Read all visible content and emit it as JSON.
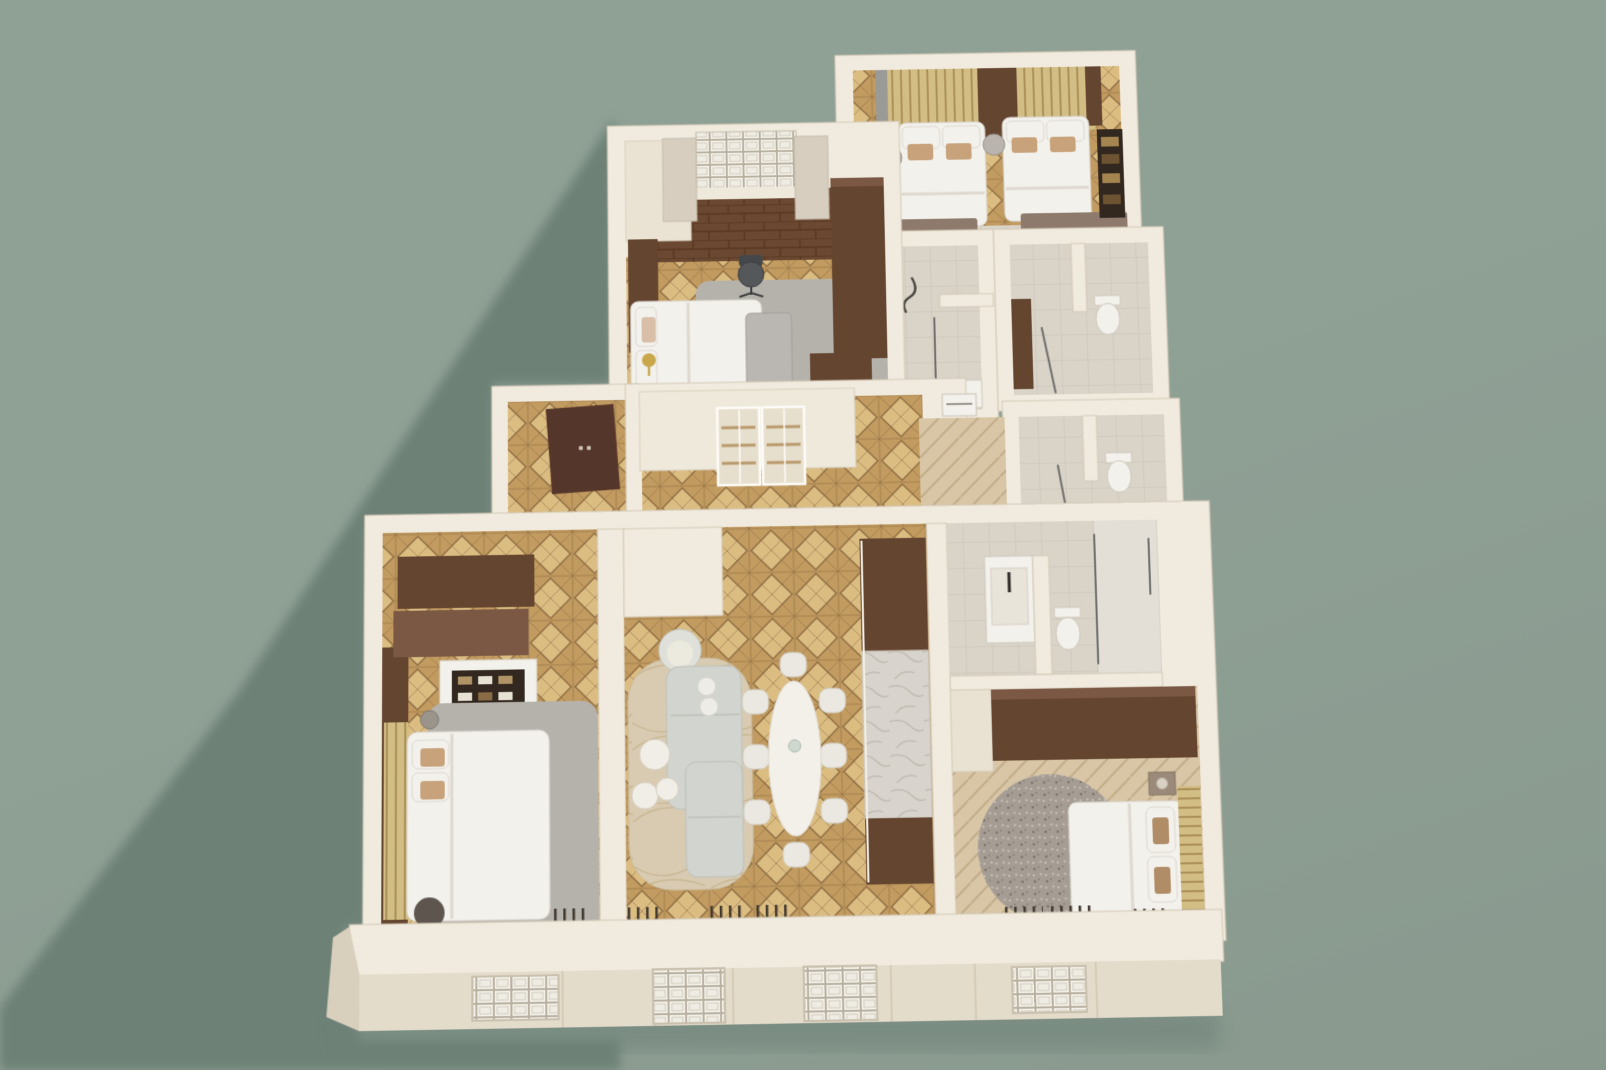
{
  "scene": {
    "type": "3d-floor-plan-render",
    "description": "Top-down 3D dollhouse render of an apartment with cream walls on a sage green background, shadow cast to the lower left",
    "visible_text": [],
    "rooms": [
      {
        "name": "twin-bedroom",
        "floor": "parquet-diamond",
        "furniture": [
          "two-double-beds",
          "slatted-headboard-wall",
          "round-nightstand",
          "foot-benches",
          "wall-shelf",
          "curtain"
        ]
      },
      {
        "name": "study-bedroom",
        "floor": "dark-wood-and-parquet",
        "furniture": [
          "window-with-curtains",
          "bed",
          "foot-bench",
          "desk",
          "office-chair",
          "gray-rug",
          "wardrobe",
          "gold-floor-lamp"
        ]
      },
      {
        "name": "entry-hall",
        "floor": "parquet-diamond",
        "furniture": [
          "entry-door",
          "glass-front-wardrobe",
          "appliance"
        ]
      },
      {
        "name": "shower-room",
        "floor": "tile",
        "furniture": [
          "shower",
          "glass-screen",
          "vanity"
        ]
      },
      {
        "name": "wc-upper",
        "floor": "tile",
        "furniture": [
          "toilet",
          "vanity-cabinet",
          "glass-screen"
        ]
      },
      {
        "name": "wc-lower",
        "floor": "tile",
        "furniture": [
          "toilet",
          "glass-screen"
        ]
      },
      {
        "name": "left-bedroom",
        "floor": "parquet-diamond",
        "furniture": [
          "wardrobes",
          "shelf-dresser",
          "bed",
          "slatted-headboard",
          "gray-rug",
          "pouf",
          "side-table"
        ]
      },
      {
        "name": "living-dining-room",
        "floor": "parquet-diamond",
        "furniture": [
          "l-shaped-sofa",
          "armchair",
          "three-coffee-tables",
          "area-rug",
          "oval-dining-table",
          "eight-chairs",
          "media-cabinet-with-marble-counter"
        ]
      },
      {
        "name": "ensuite-bathroom",
        "floor": "tile",
        "furniture": [
          "vanity",
          "toilet",
          "walk-in-shower"
        ]
      },
      {
        "name": "right-bedroom",
        "floor": "herringbone",
        "furniture": [
          "wardrobe-wall",
          "round-rug",
          "bed",
          "slatted-headboard",
          "nightstand-lamp"
        ]
      }
    ],
    "facade": {
      "windows": 4,
      "style": "recessed white grid windows in cream front wall"
    }
  },
  "palette": {
    "bg-light": "#8fa095",
    "bg-mid": "#89998e",
    "shadow": "#6d8177",
    "wall-cap": "#f1ebdf",
    "wall-face": "#e4dccb",
    "wall-side": "#d8cfbc",
    "wall-edge": "#d3c9b6",
    "wood-dark": "#64452f",
    "wood-mid": "#7a5844",
    "taupe": "#8d7a6c",
    "bedding": "#f3f1ec",
    "rug-gray": "#b5b2ac",
    "rug-beige": "#d9cbb2",
    "rug-speckle": "#a59d94",
    "parq-base": "#c29b60",
    "parq-light": "#dbbd82",
    "parq-dark": "#8e6c41",
    "herr-base": "#d8c6a6",
    "herr-line": "#c2ad8a",
    "tile-base": "#d9d3c8",
    "tile-line": "#c9c2b5",
    "dkfloor": "#6b4831",
    "dkfloor-line": "#57371f",
    "slat-base": "#d2bd85",
    "slat-line": "#ab9158",
    "curtain": "#d7cec0",
    "curtain-gray": "#9a9a96",
    "marble": "#d8d3cc",
    "marble-vein": "#bfb9b0",
    "glass-line": "#6f6f6d",
    "sofa": "#d2d5cf",
    "chair-white": "#eae8e1",
    "gold": "#c9a84c",
    "dark-shelf": "#32281f",
    "radiator": "#423a30",
    "window-pane": "#f8f6f0",
    "window-frame": "#c9c0ae"
  }
}
